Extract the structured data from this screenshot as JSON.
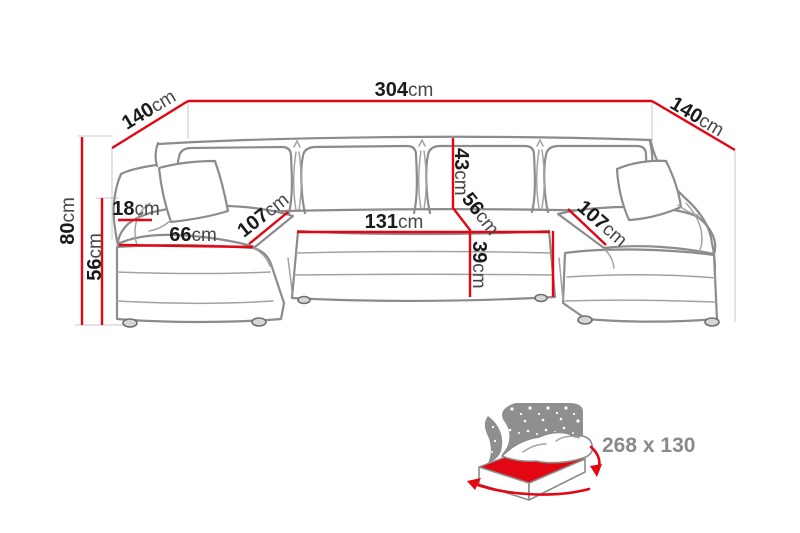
{
  "colors": {
    "dimension_red": "#e30613",
    "drawing_gray": "#8c8c8c",
    "number_black": "#1b1b1b",
    "unit_gray": "#474747",
    "icon_gray": "#8f8f8f",
    "background": "#ffffff"
  },
  "dimensions": {
    "total_width": {
      "value": "304",
      "unit": "cm"
    },
    "left_side_depth": {
      "value": "140",
      "unit": "cm"
    },
    "right_side_depth": {
      "value": "140",
      "unit": "cm"
    },
    "overall_height": {
      "value": "80",
      "unit": "cm"
    },
    "base_height": {
      "value": "56",
      "unit": "cm"
    },
    "armrest_width": {
      "value": "18",
      "unit": "cm"
    },
    "left_chaise_front_width": {
      "value": "66",
      "unit": "cm"
    },
    "left_chaise_seat_depth": {
      "value": "107",
      "unit": "cm"
    },
    "center_seat_width": {
      "value": "131",
      "unit": "cm"
    },
    "backrest_cushion_height": {
      "value": "43",
      "unit": "cm"
    },
    "seat_depth": {
      "value": "56",
      "unit": "cm"
    },
    "seat_front_height": {
      "value": "39",
      "unit": "cm"
    },
    "right_chaise_seat_depth": {
      "value": "107",
      "unit": "cm"
    }
  },
  "sleeping_area": {
    "size_label": "268 x 130"
  }
}
